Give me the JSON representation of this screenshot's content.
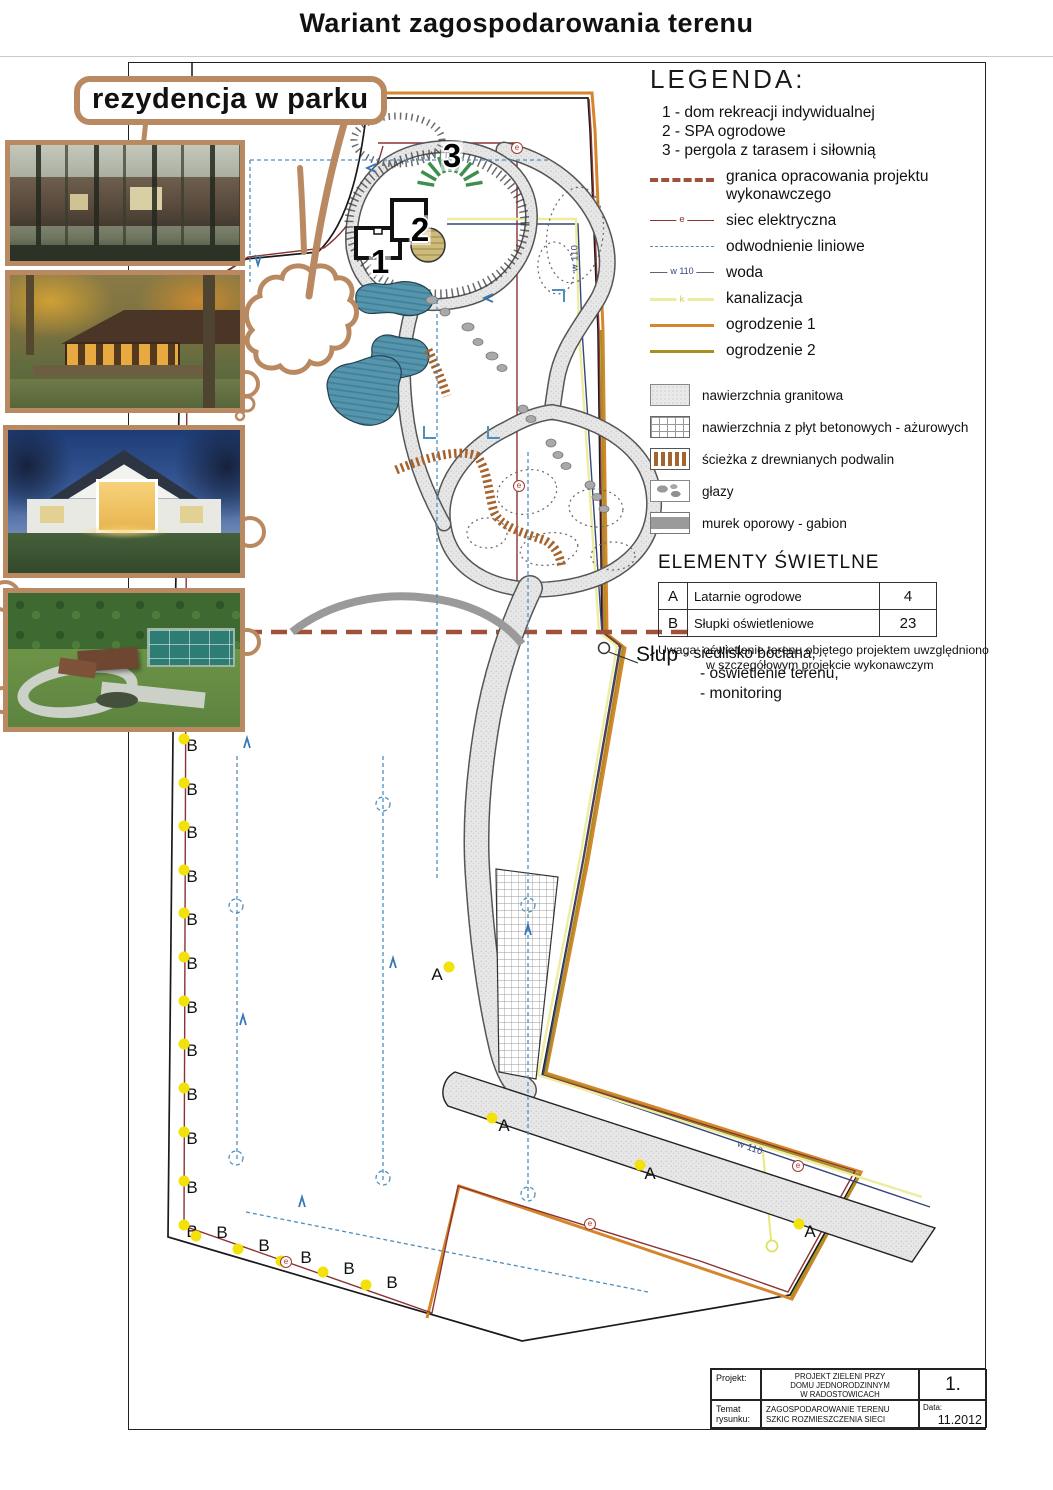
{
  "page": {
    "title": "Wariant zagospodarowania terenu"
  },
  "annotation": {
    "label": "rezydencja w parku"
  },
  "legend": {
    "heading": "LEGENDA:",
    "numbered_items": [
      "1 - dom rekreacji indywidualnej",
      "2 - SPA ogrodowe",
      "3 - pergola z tarasem i siłownią"
    ],
    "line_items": [
      {
        "symbol": "granica-dashed",
        "label": "granica opracowania projektu wykonawczego",
        "mid": ""
      },
      {
        "symbol": "electric-line",
        "label": "siec elektryczna",
        "mid": "e"
      },
      {
        "symbol": "drainage-dashed",
        "label": "odwodnienie liniowe",
        "mid": ""
      },
      {
        "symbol": "water-line",
        "label": "woda",
        "mid": "w 110"
      },
      {
        "symbol": "sewer-line",
        "label": "kanalizacja",
        "mid": "k"
      },
      {
        "symbol": "fence1-line",
        "label": "ogrodzenie 1",
        "mid": ""
      },
      {
        "symbol": "fence2-line",
        "label": "ogrodzenie 2",
        "mid": ""
      }
    ],
    "surface_items": [
      {
        "symbol": "granite",
        "label": "nawierzchnia granitowa"
      },
      {
        "symbol": "plates",
        "label": "nawierzchnia z płyt betonowych - ażurowych"
      },
      {
        "symbol": "wood",
        "label": "ścieżka z drewnianych podwalin"
      },
      {
        "symbol": "boulders",
        "label": "głazy"
      },
      {
        "symbol": "gabion",
        "label": "murek oporowy - gabion"
      }
    ]
  },
  "lighting": {
    "heading": "ELEMENTY ŚWIETLNE",
    "rows": [
      {
        "code": "A",
        "label": "Latarnie ogrodowe",
        "count": "4"
      },
      {
        "code": "B",
        "label": "Słupki oświetleniowe",
        "count": "23"
      }
    ],
    "note_line1": "Uwaga:  oświetlenie terenu objętego projektem uwzględniono",
    "note_line2": "w szczegółowym projekcie wykonawczym"
  },
  "pole_note": {
    "title": "Słup",
    "lines": [
      "- siedlisko bociana,",
      "- oświetlenie terenu,",
      "- monitoring"
    ]
  },
  "title_block": {
    "project_label": "Projekt:",
    "project_value_lines": [
      "PROJEKT ZIELENI PRZY",
      "DOMU JEDNORODZINNYM",
      "W RADOSTOWICACH"
    ],
    "sheet_number": "1.",
    "subject_label_lines": [
      "Temat",
      "rysunku:"
    ],
    "subject_value_lines": [
      "ZAGOSPODAROWANIE TERENU",
      "SZKIC ROZMIESZCZENIA SIECI"
    ],
    "date_label": "Data:",
    "date_value": "11.2012"
  },
  "colors": {
    "marker_tan": "#b98a62",
    "granica": "#a0513a",
    "electric": "#8b3330",
    "drainage": "#4d8fbf",
    "water": "#36457c",
    "sewer": "#ededa0",
    "fence1": "#d5862c",
    "fence2": "#a98f1f",
    "lamp_dot": "#f2e20a",
    "pond": "#5795ad",
    "pergola_green": "#3e8e4e"
  },
  "plan": {
    "markers": [
      {
        "k": "bignum",
        "x": 380,
        "y": 262,
        "t": "1"
      },
      {
        "k": "bignum",
        "x": 420,
        "y": 230,
        "t": "2"
      },
      {
        "k": "bignum",
        "x": 452,
        "y": 156,
        "t": "3"
      },
      {
        "k": "wlabel",
        "x": 575,
        "y": 258,
        "rot": -90,
        "t": "w 110"
      },
      {
        "k": "wlabel",
        "x": 750,
        "y": 1148,
        "rot": 19,
        "t": "w 110"
      },
      {
        "k": "lamp-label",
        "x": 437,
        "y": 975,
        "t": "A"
      },
      {
        "k": "lamp-label",
        "x": 504,
        "y": 1126,
        "t": "A"
      },
      {
        "k": "lamp-label",
        "x": 650,
        "y": 1174,
        "t": "A"
      },
      {
        "k": "lamp-label",
        "x": 810,
        "y": 1232,
        "t": "A"
      },
      {
        "k": "dot",
        "x": 449,
        "y": 967
      },
      {
        "k": "dot",
        "x": 492,
        "y": 1118
      },
      {
        "k": "dot",
        "x": 640,
        "y": 1165
      },
      {
        "k": "dot",
        "x": 799,
        "y": 1224
      },
      {
        "k": "lamp-label",
        "x": 192,
        "y": 746,
        "t": "B"
      },
      {
        "k": "lamp-label",
        "x": 192,
        "y": 790,
        "t": "B"
      },
      {
        "k": "lamp-label",
        "x": 192,
        "y": 833,
        "t": "B"
      },
      {
        "k": "lamp-label",
        "x": 192,
        "y": 877,
        "t": "B"
      },
      {
        "k": "lamp-label",
        "x": 192,
        "y": 920,
        "t": "B"
      },
      {
        "k": "lamp-label",
        "x": 192,
        "y": 964,
        "t": "B"
      },
      {
        "k": "lamp-label",
        "x": 192,
        "y": 1008,
        "t": "B"
      },
      {
        "k": "lamp-label",
        "x": 192,
        "y": 1051,
        "t": "B"
      },
      {
        "k": "lamp-label",
        "x": 192,
        "y": 1095,
        "t": "B"
      },
      {
        "k": "lamp-label",
        "x": 192,
        "y": 1139,
        "t": "B"
      },
      {
        "k": "lamp-label",
        "x": 192,
        "y": 1188,
        "t": "B"
      },
      {
        "k": "lamp-label",
        "x": 192,
        "y": 1232,
        "t": "B"
      },
      {
        "k": "dot",
        "x": 184,
        "y": 739
      },
      {
        "k": "dot",
        "x": 184,
        "y": 783
      },
      {
        "k": "dot",
        "x": 184,
        "y": 826
      },
      {
        "k": "dot",
        "x": 184,
        "y": 870
      },
      {
        "k": "dot",
        "x": 184,
        "y": 913
      },
      {
        "k": "dot",
        "x": 184,
        "y": 957
      },
      {
        "k": "dot",
        "x": 184,
        "y": 1001
      },
      {
        "k": "dot",
        "x": 184,
        "y": 1044
      },
      {
        "k": "dot",
        "x": 184,
        "y": 1088
      },
      {
        "k": "dot",
        "x": 184,
        "y": 1132
      },
      {
        "k": "dot",
        "x": 184,
        "y": 1181
      },
      {
        "k": "dot",
        "x": 184,
        "y": 1225
      },
      {
        "k": "lamp-label",
        "x": 222,
        "y": 1233,
        "t": "B"
      },
      {
        "k": "lamp-label",
        "x": 264,
        "y": 1246,
        "t": "B"
      },
      {
        "k": "lamp-label",
        "x": 306,
        "y": 1258,
        "t": "B"
      },
      {
        "k": "lamp-label",
        "x": 349,
        "y": 1269,
        "t": "B"
      },
      {
        "k": "lamp-label",
        "x": 392,
        "y": 1283,
        "t": "B"
      },
      {
        "k": "dot",
        "x": 196,
        "y": 1236
      },
      {
        "k": "dot",
        "x": 238,
        "y": 1249
      },
      {
        "k": "dot",
        "x": 281,
        "y": 1261
      },
      {
        "k": "dot",
        "x": 323,
        "y": 1272
      },
      {
        "k": "dot",
        "x": 366,
        "y": 1285
      },
      {
        "k": "enode",
        "x": 517,
        "y": 148,
        "t": "e"
      },
      {
        "k": "enode",
        "x": 519,
        "y": 486,
        "t": "e"
      },
      {
        "k": "enode",
        "x": 286,
        "y": 1262,
        "t": "e"
      },
      {
        "k": "enode",
        "x": 590,
        "y": 1224,
        "t": "e"
      },
      {
        "k": "enode",
        "x": 798,
        "y": 1166,
        "t": "e"
      }
    ]
  }
}
